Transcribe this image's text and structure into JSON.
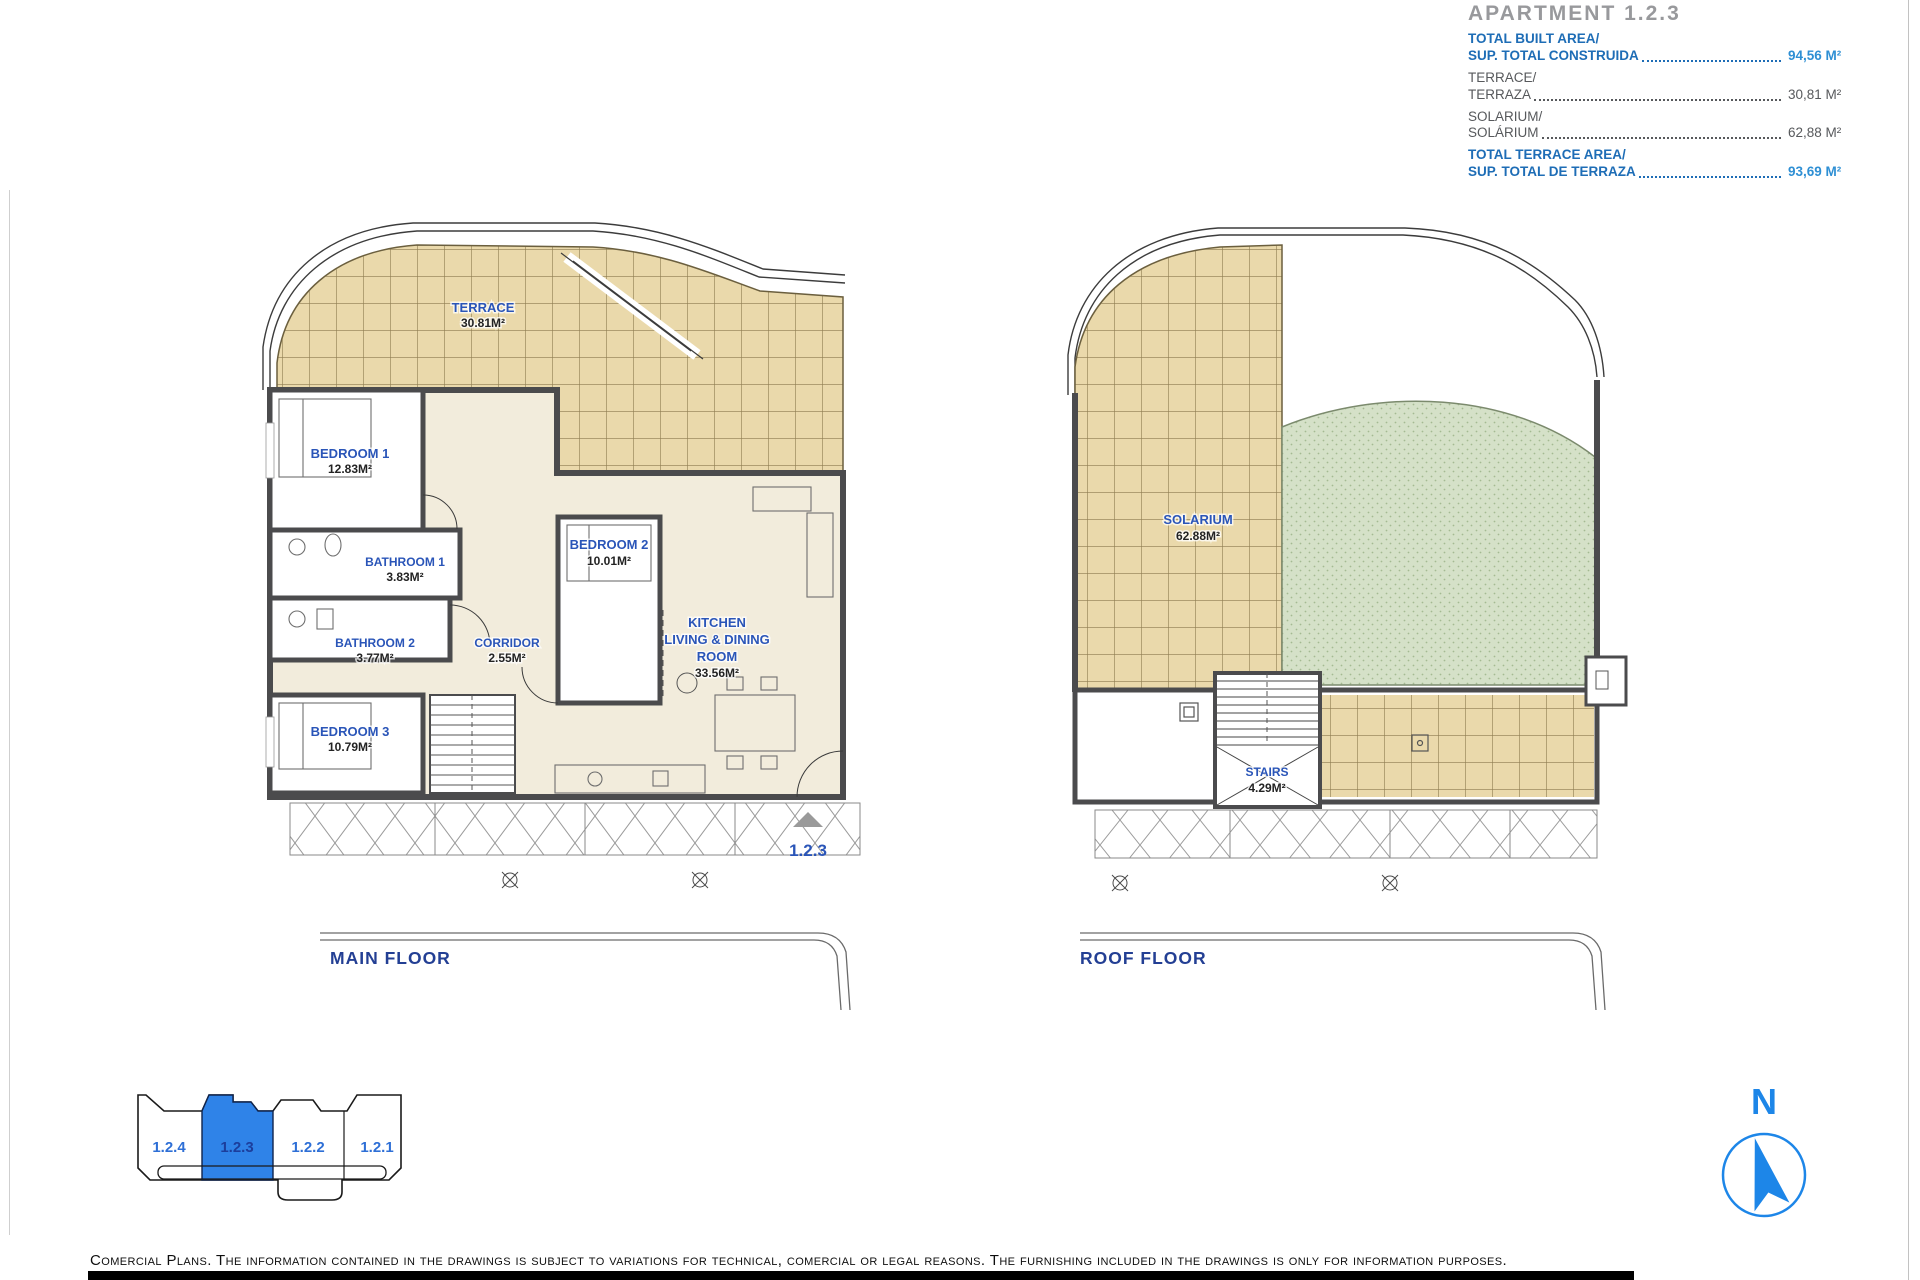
{
  "header": {
    "title": "APARTMENT 1.2.3",
    "rows": [
      {
        "label_en": "TOTAL BUILT AREA/",
        "label_es": "SUP. TOTAL CONSTRUIDA",
        "value": "94,56 M²"
      },
      {
        "label_en": "TERRACE/",
        "label_es": "TERRAZA",
        "value": "30,81 M²"
      },
      {
        "label_en": "SOLARIUM/",
        "label_es": "SOLÁRIUM",
        "value": "62,88 M²"
      },
      {
        "label_en": "TOTAL TERRACE AREA/",
        "label_es": "SUP. TOTAL DE TERRAZA",
        "value": "93,69 M²"
      }
    ]
  },
  "main_floor": {
    "caption": "MAIN FLOOR",
    "entrance_marker": "1.2.3",
    "rooms": {
      "terrace": {
        "name": "TERRACE",
        "area": "30.81M²"
      },
      "bedroom1": {
        "name": "BEDROOM 1",
        "area": "12.83M²"
      },
      "bathroom1": {
        "name": "BATHROOM 1",
        "area": "3.83M²"
      },
      "bathroom2": {
        "name": "BATHROOM 2",
        "area": "3.77M²"
      },
      "corridor": {
        "name": "CORRIDOR",
        "area": "2.55M²"
      },
      "bedroom2": {
        "name": "BEDROOM 2",
        "area": "10.01M²"
      },
      "kitchen": {
        "line1": "KITCHEN",
        "line2": "LIVING & DINING",
        "line3": "ROOM",
        "area": "33.56M²"
      },
      "bedroom3": {
        "name": "BEDROOM 3",
        "area": "10.79M²"
      }
    }
  },
  "roof_floor": {
    "caption": "ROOF FLOOR",
    "rooms": {
      "solarium": {
        "name": "SOLARIUM",
        "area": "62.88M²"
      },
      "stairs": {
        "name": "STAIRS",
        "area": "4.29M²"
      }
    }
  },
  "key_plan": {
    "units": [
      {
        "label": "1.2.4",
        "selected": false
      },
      {
        "label": "1.2.3",
        "selected": true
      },
      {
        "label": "1.2.2",
        "selected": false
      },
      {
        "label": "1.2.1",
        "selected": false
      }
    ]
  },
  "compass": {
    "north_label": "N"
  },
  "footer": {
    "disclaimer": "Comercial Plans. The information contained in the drawings is subject to variations for technical, comercial or legal reasons. The furnishing included in the drawings is only for information purposes."
  },
  "colors": {
    "room_label_blue": "#2a55b8",
    "info_label_blue": "#1e6db6",
    "info_value_blue": "#2e8fd4",
    "selected_unit_fill": "#2f83e8",
    "tile_fill": "#ead9ab",
    "solarium_green": "#d5e1c8",
    "caption_navy": "#233f94"
  }
}
